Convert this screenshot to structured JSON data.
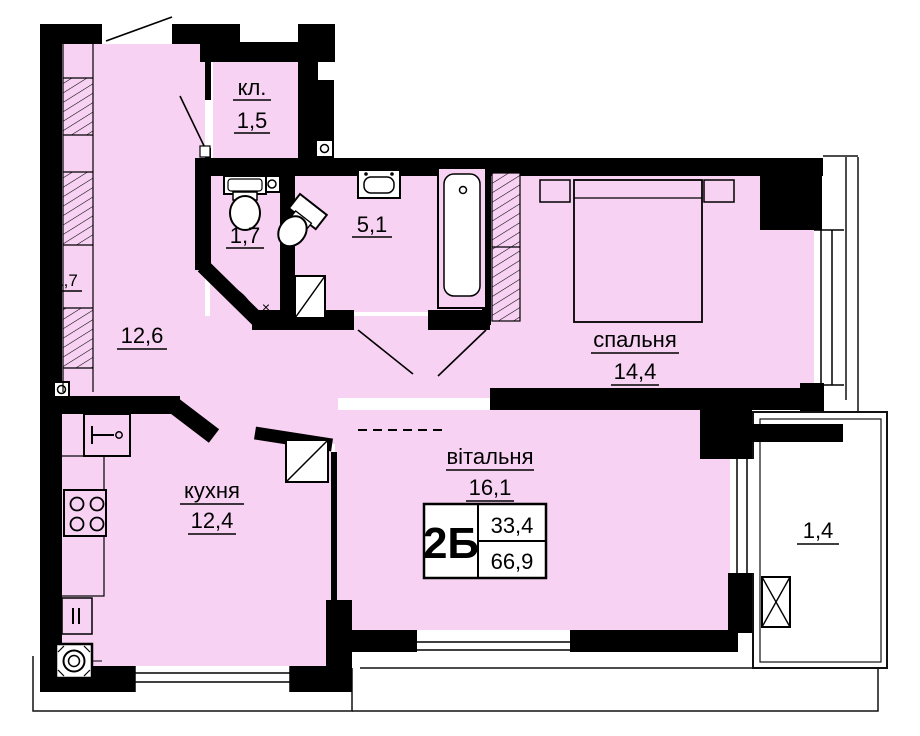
{
  "title": "Apartment floor plan 2Б",
  "colors": {
    "floor": "#F8D2F3",
    "wall": "#000000",
    "background": "#FFFFFF",
    "outline": "#111111"
  },
  "unit_card": {
    "unit": "2Б",
    "living_area": "33,4",
    "total_area": "66,9"
  },
  "rooms": {
    "closet": {
      "name": "кл.",
      "area": "1,5"
    },
    "wc": {
      "area": "1,7"
    },
    "bathroom": {
      "area": "5,1"
    },
    "bedroom": {
      "name": "спальня",
      "area": "14,4"
    },
    "hallway": {
      "area": "12,6"
    },
    "kitchen": {
      "name": "кухня",
      "area": "12,4"
    },
    "living_room": {
      "name": "вітальня",
      "area": "16,1"
    },
    "balcony": {
      "area": "1,4"
    },
    "wardrobe": {
      "area": "1,7"
    }
  },
  "door_mark": "×"
}
